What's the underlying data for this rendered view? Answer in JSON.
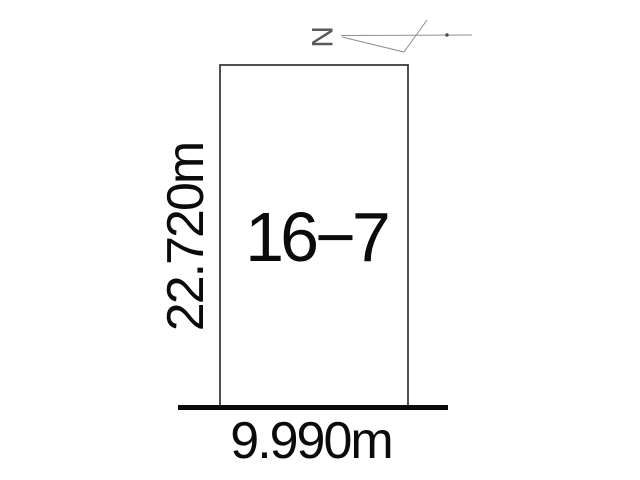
{
  "diagram": {
    "plot": {
      "lot_number": "16−7",
      "depth_label": "22.720m",
      "frontage_label": "9.990m"
    },
    "north_arrow": {
      "label": "N"
    },
    "colors": {
      "background": "#ffffff",
      "boundary_line": "#3c3c3c",
      "road_line": "#0a0a0a",
      "arrow_line": "#8f8f8f",
      "text": "#0b0b0b"
    }
  }
}
